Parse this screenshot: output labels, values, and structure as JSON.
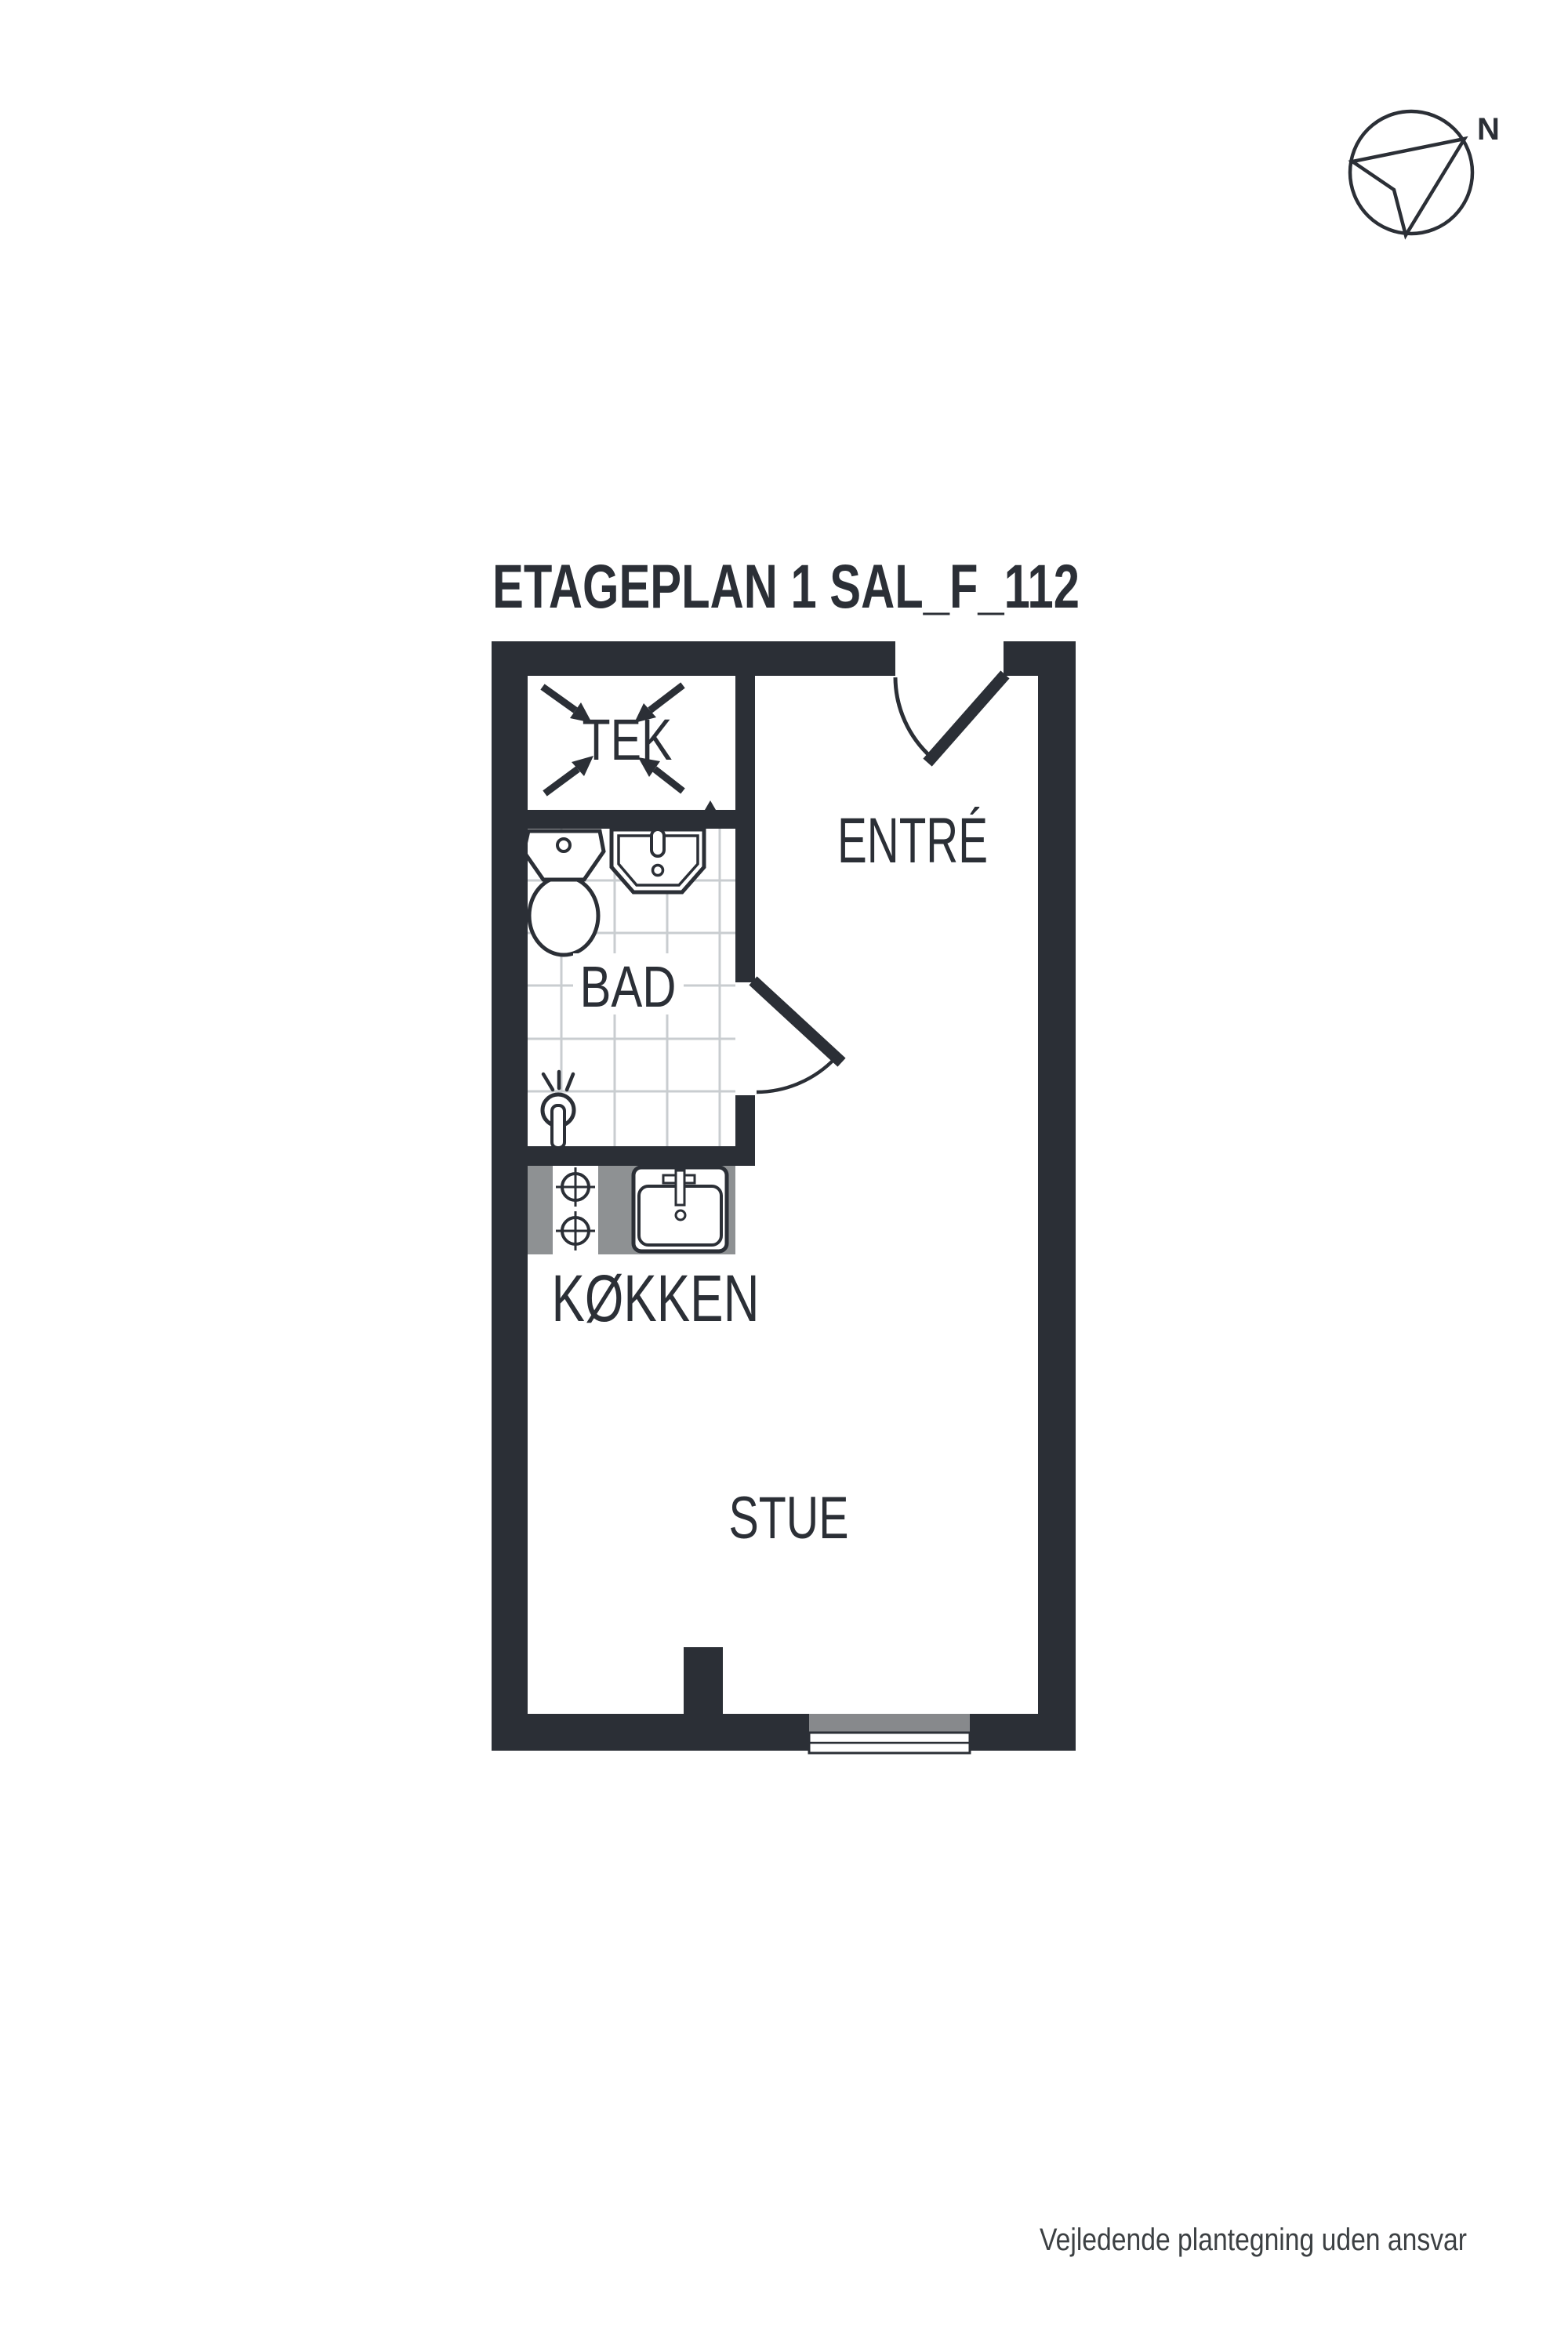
{
  "title": "ETAGEPLAN 1 SAL_F_112",
  "compass": {
    "north_label": "N",
    "icon": "north-arrow-icon"
  },
  "rooms": {
    "tek": {
      "label": "TEK"
    },
    "entre": {
      "label": "ENTRÉ"
    },
    "bad": {
      "label": "BAD"
    },
    "kokken": {
      "label": "KØKKEN"
    },
    "stue": {
      "label": "STUE"
    }
  },
  "fixtures": [
    "toilet-icon",
    "bathroom-sink-icon",
    "shower-icon",
    "stove-burners-icon",
    "kitchen-sink-icon",
    "entrance-door-icon",
    "bathroom-door-icon",
    "window-icon",
    "void-cross-icon"
  ],
  "footer": {
    "disclaimer": "Vejledende plantegning uden ansvar"
  },
  "colors": {
    "wall": "#2b2f36",
    "counter": "#8e9193",
    "window_sill": "#87898c",
    "tile_line": "#c9cdd0",
    "footer_text": "#3c4043",
    "background": "#ffffff"
  }
}
